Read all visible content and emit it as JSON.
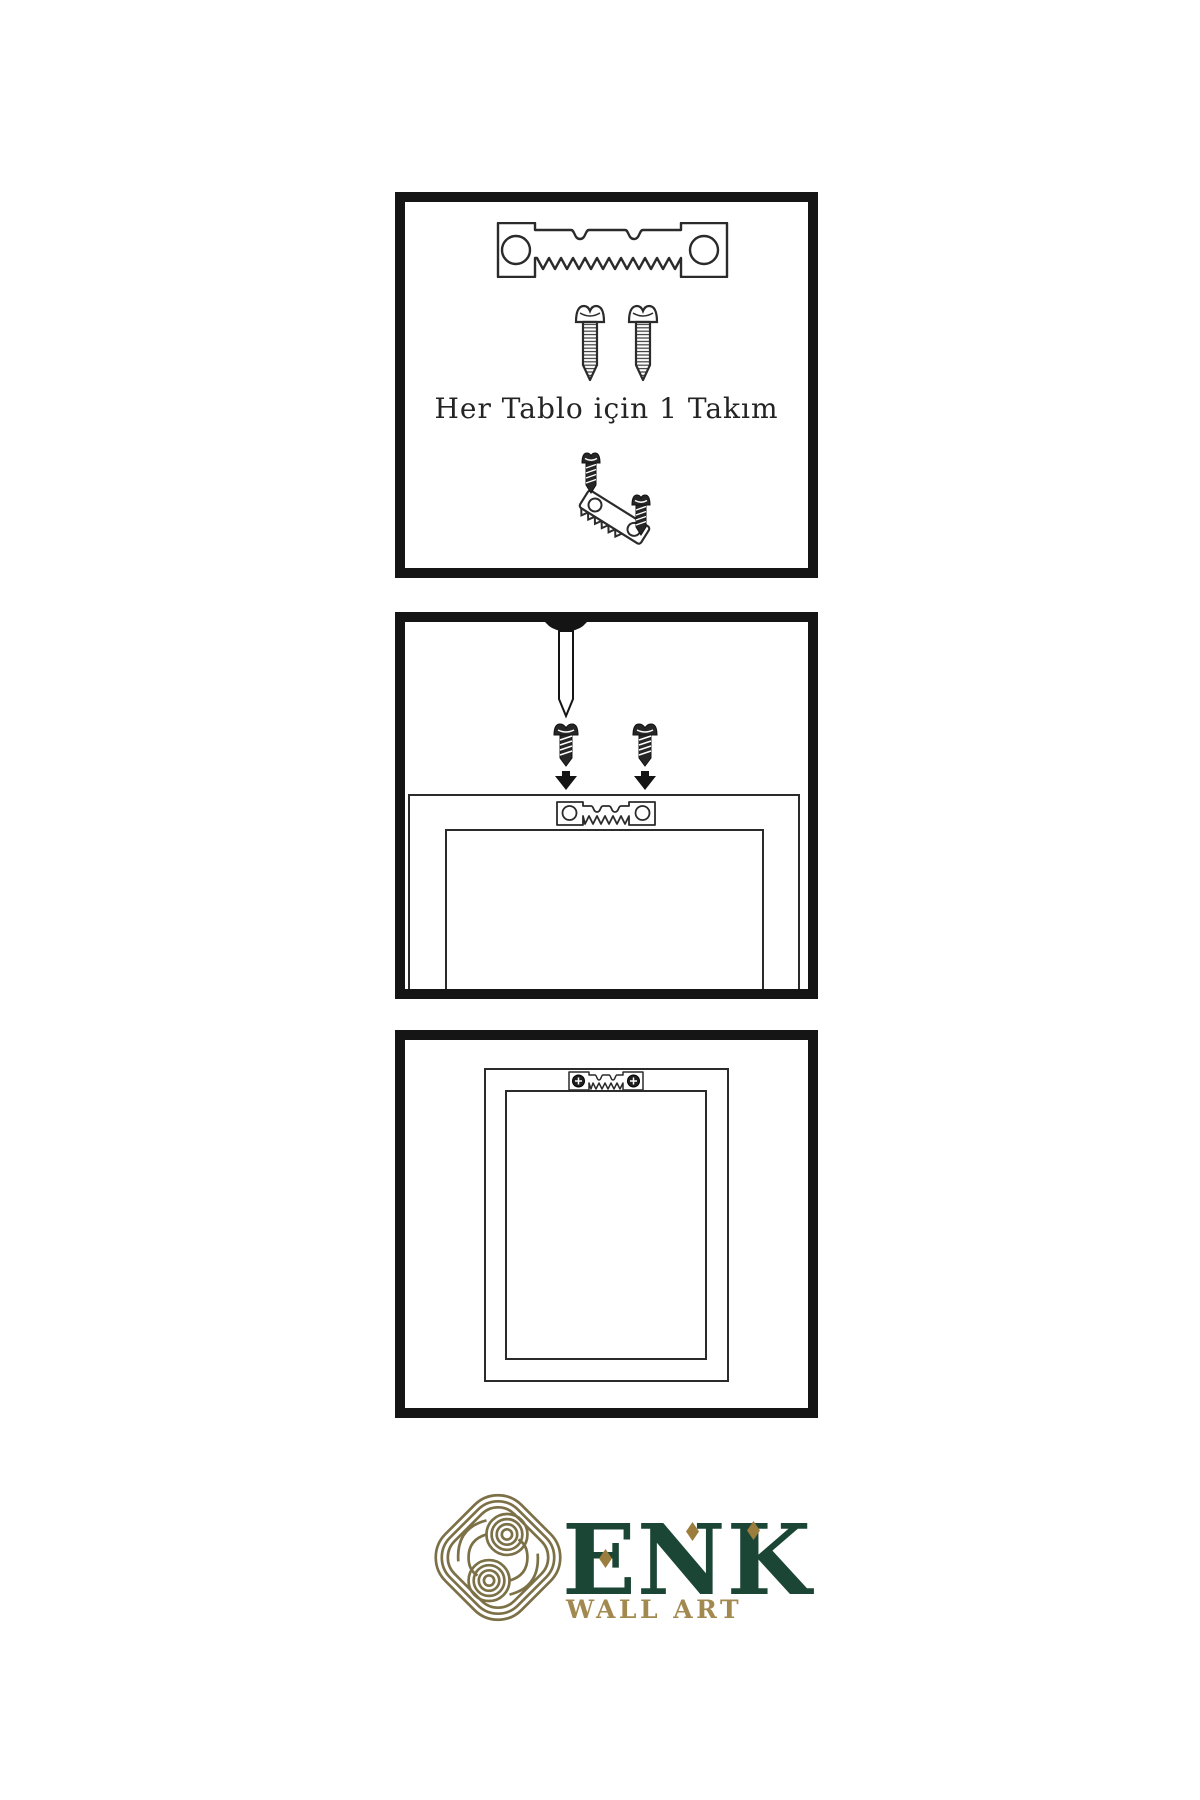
{
  "instructions": {
    "step1_caption": "Her Tablo için 1 Takım"
  },
  "illustrations": {
    "panel1": [
      "sawtooth-hanger",
      "screw",
      "screw",
      "screw-into-tilted-hanger"
    ],
    "panel2": [
      "wall-nail",
      "screw-with-down-arrow",
      "screw-with-down-arrow",
      "frame-back-with-sawtooth-hanger"
    ],
    "panel3": [
      "frame-back-hanging-with-mounted-hanger"
    ]
  },
  "logo": {
    "brand": "ENK",
    "subtitle": "WALL ART",
    "colors": {
      "knot_gold": "#7c7047",
      "brand_green": "#1b4636",
      "accent_gold": "#9b7e3e",
      "subtitle_gold": "#a1894f"
    }
  },
  "colors": {
    "background": "#ffffff",
    "panel_border": "#151515",
    "line_art": "#2b2b2b"
  }
}
